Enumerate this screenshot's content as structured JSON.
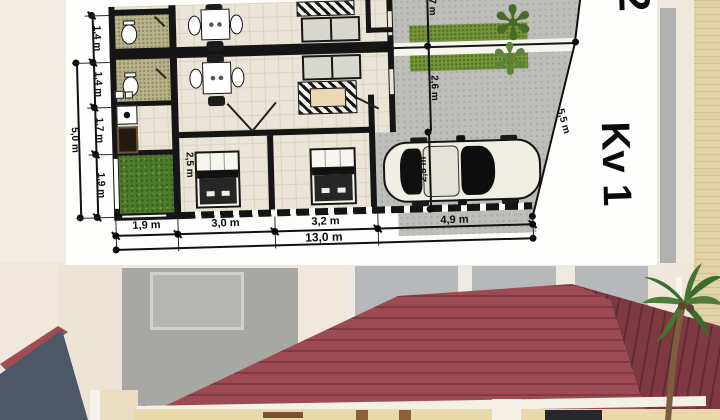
{
  "plan": {
    "left_chain": [
      "1,4 m",
      "1,4 m",
      "1,7 m",
      "1,9 m"
    ],
    "left_total": "5,0 m",
    "bottom_chain": [
      "1,9 m",
      "3,0 m",
      "3,2 m",
      "4,9 m"
    ],
    "bottom_total": "13,0 m",
    "right_top_dim": "7 m",
    "right_mid_dim": "2,6 m",
    "diagonal_dim": "5,5 m",
    "bedroom_width": "2,5 m",
    "carport_width": "2,5 m",
    "plot_number_partial": "2",
    "plot_label": "Kv 1",
    "plant_glyph": "✻"
  },
  "colors": {
    "roof_red": "#9d4a52",
    "roof_red_dark": "#7e3a41",
    "gable_slate": "#4d5768",
    "hedge_green": "#75953d",
    "garden_green": "#4e7a2d",
    "paving_gray": "#bdbdb9",
    "background_cream": "#f0e9db",
    "wall_yellow": "#e9d9a9"
  }
}
